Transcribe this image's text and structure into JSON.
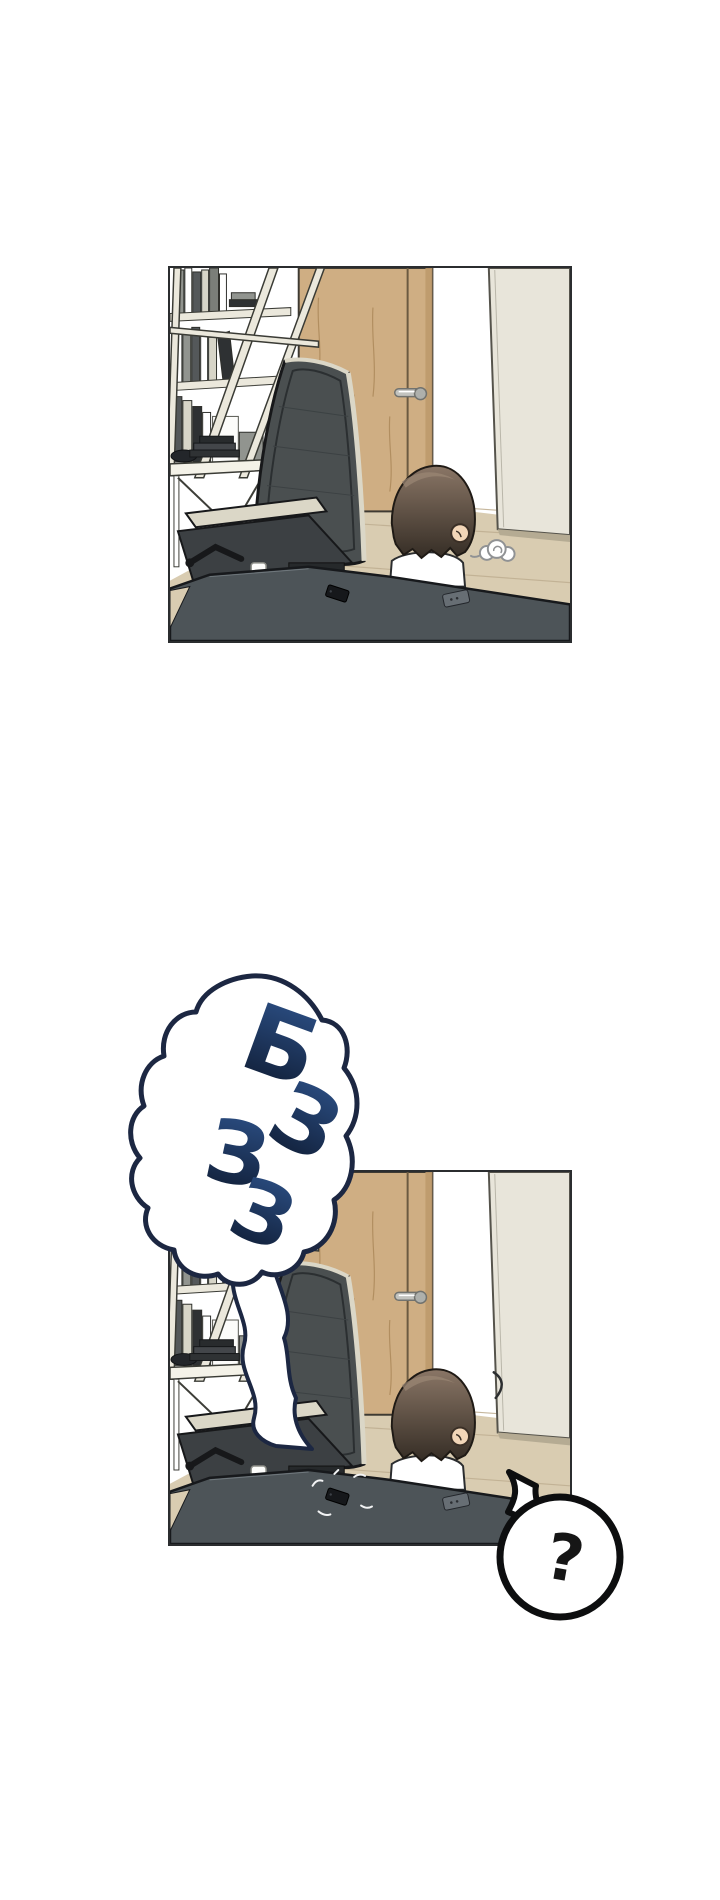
{
  "page": {
    "width": 720,
    "height": 1900,
    "background": "#ffffff",
    "kind": "vertical webtoon comic strip, two panels"
  },
  "panels": [
    {
      "id": "panel-1",
      "x": 168,
      "y": 266,
      "width": 404,
      "height": 377,
      "alt": "Boy with dark hair in a white shirt sits at a dark desk facing a wooden door; leaning bookshelf, side desk and mesh office chair at left, open light door at right, a small sigh puff beside his head, a phone lying on the desk"
    },
    {
      "id": "panel-2",
      "x": 168,
      "y": 1170,
      "width": 404,
      "height": 376,
      "alt": "Same room; the phone on the desk vibrates with a buzzing sound bubble pointing at it and the boy starts turning his head"
    }
  ],
  "sfx_bubble": {
    "text": "БЗЗЗ",
    "letters": [
      "Б",
      "З",
      "З",
      "З"
    ],
    "fill": "#ffffff",
    "stroke": "#1c2742"
  },
  "question_bubble": {
    "text": "?",
    "fill": "#ffffff",
    "stroke": "#0d0e0f",
    "ink": "#161616"
  },
  "colors": {
    "panel_border": "#2b2d2f",
    "wall": "#ffffff",
    "wall_corner": "#efe9da",
    "door_wood": "#cfae83",
    "door_grain": "#b18e60",
    "door_edge": "#3e3a32",
    "door_stile": "#6b5a41",
    "handle_metal": "#c2c3bf",
    "open_door": "#e8e5da",
    "open_door_edge": "#55534b",
    "floor": "#d9ccb1",
    "floor_line": "#c0b093",
    "desk": "#4d5458",
    "desk_edge": "#17191c",
    "shelf_frame": "#ebe8dc",
    "shelf_outline": "#3a3b35",
    "chair_mesh": "#4a4f50",
    "chair_frame": "#dbd7c7",
    "chair_dark": "#17181a",
    "seat": "#3c4043",
    "hair_light": "#8a7666",
    "hair_dark": "#352d25",
    "hair_outline": "#1f1a15",
    "skin": "#f2d6b8",
    "shirt": "#ffffff",
    "shirt_outline": "#2b2d2f",
    "phone": "#16181b",
    "remote": "#676e74",
    "sfx_top": "#2d5188",
    "sfx_bottom": "#0e1a30",
    "puff_outline": "#909294",
    "mark": "#f2f3f4",
    "books": [
      "#ffffff",
      "#91948f",
      "#54585a",
      "#2e3133",
      "#d7d5c8",
      "#7b7e79"
    ]
  }
}
